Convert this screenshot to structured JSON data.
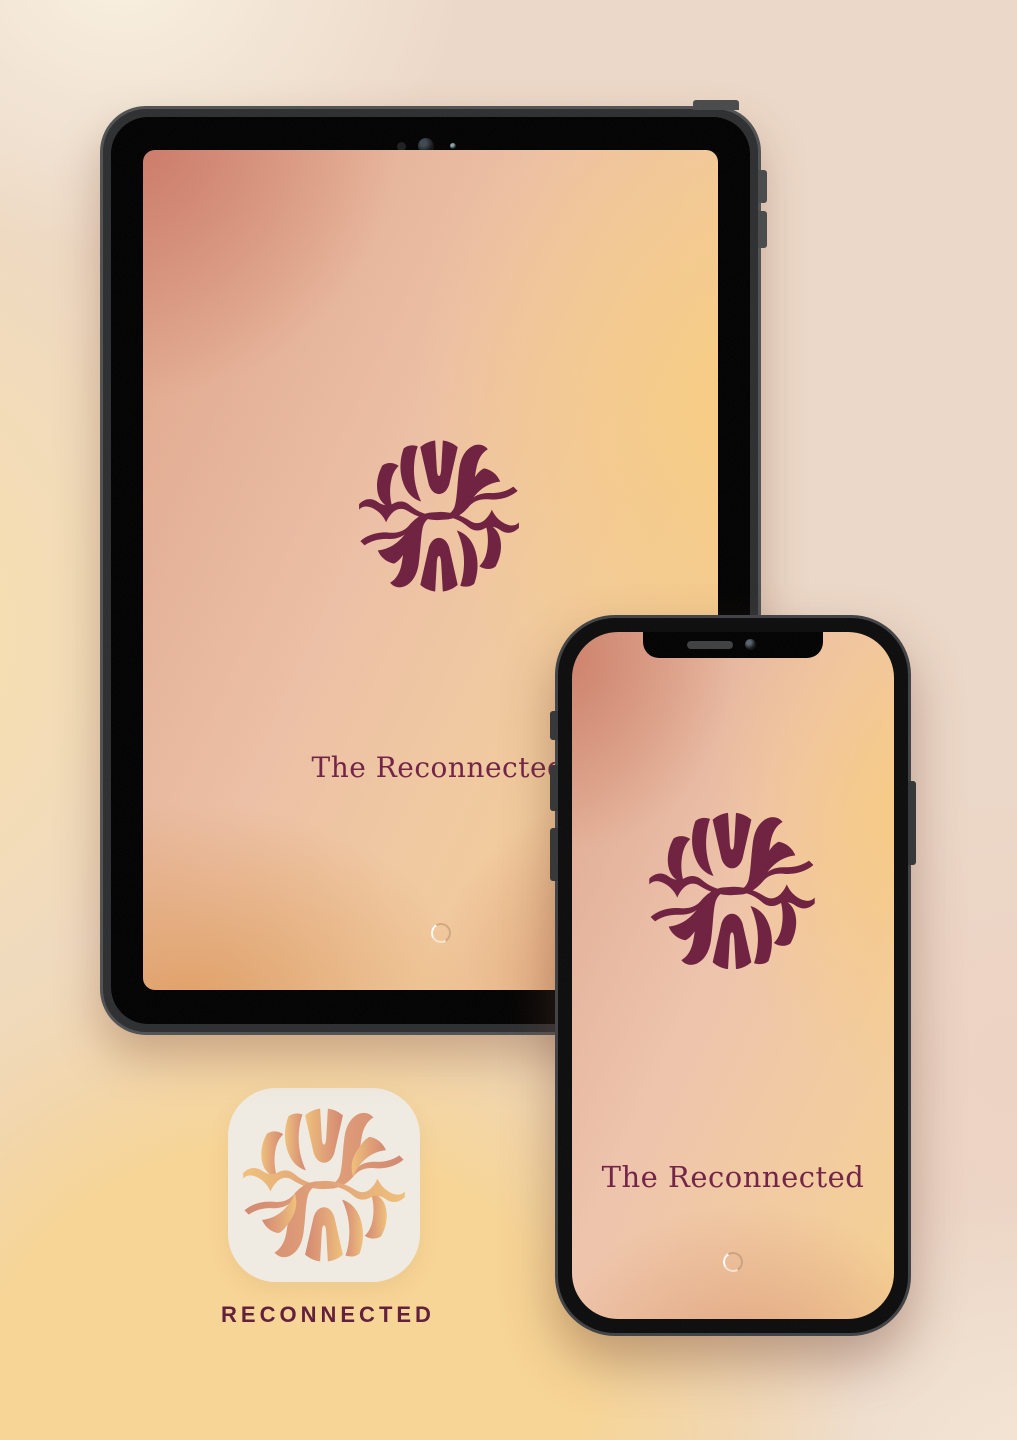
{
  "brand": {
    "name": "The Reconnected",
    "burgundy": "#6d1f3e",
    "logo_icon": "sunburst-wave-logo"
  },
  "tablet": {
    "device": "tablet-splash-mockup",
    "app_title": "The Reconnected",
    "spinner_icon": "loading-spinner"
  },
  "phone": {
    "device": "phone-splash-mockup",
    "app_title": "The Reconnected",
    "spinner_icon": "loading-spinner"
  },
  "app_icon": {
    "label": "RECONNECTED",
    "background": "#f0ebe1",
    "gradient_start": "#efc079",
    "gradient_end": "#d2876f"
  },
  "poster": {
    "background_base": "#ecd7c7",
    "background_cream": "#f8f1e2",
    "background_yellow": "#f7d494"
  }
}
